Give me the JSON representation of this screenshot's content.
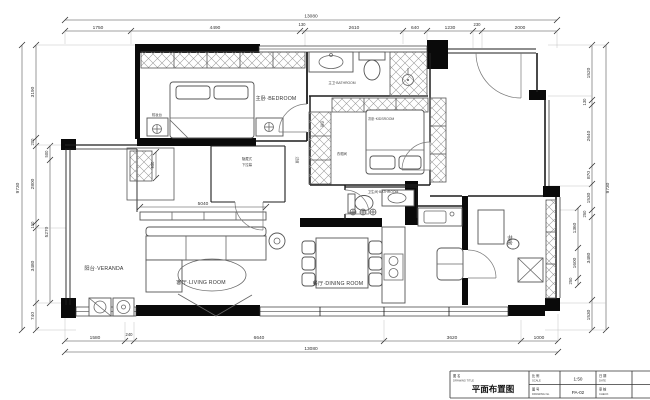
{
  "dims": {
    "top": {
      "overall": "13080",
      "segments": [
        "1750",
        "4490",
        "130",
        "2610",
        "640",
        "1230",
        "230",
        "2000"
      ]
    },
    "bottom": {
      "overall": "13080",
      "segments": [
        "1580",
        "240",
        "6640",
        "3620",
        "1000"
      ]
    },
    "left": {
      "overall": "9730",
      "segments": [
        "3190",
        "200",
        "2800",
        "150",
        "3480",
        "740"
      ],
      "inner": [
        "500",
        "5270"
      ]
    },
    "right": {
      "overall": "9730",
      "segments": [
        "1520",
        "130",
        "2640",
        "870",
        "1530",
        "250",
        "3480",
        "1530"
      ],
      "inner": [
        "1360",
        "1600",
        "250"
      ]
    },
    "interior": {
      "sofa_wall": "5040",
      "closet_depth": "950"
    }
  },
  "rooms": {
    "master_bedroom": "主卧·BEDROOM",
    "master_bath": "主卫·BATHROOM",
    "kids_room": "次卧·KIDSROOM",
    "wardrobe": "衣柜",
    "closet": "衣帽间",
    "bathroom": "卫生间·BATHROOM",
    "dining": "餐厅·DINING ROOM",
    "living": "客厅·LIVING ROOM",
    "veranda": "阳台·VERANDA",
    "study": "书房",
    "hallway": "过道",
    "dresser": "梳妆台",
    "projector_l1": "隐藏式",
    "projector_l2": "下拉幕"
  },
  "titleblock": {
    "name_label": "图 名",
    "name_label_en": "DRAWING TITLE",
    "title": "平面布置图",
    "scale_label": "比 例",
    "scale_label_en": "SCALE",
    "scale_value": "1:50",
    "no_label": "图 号",
    "no_label_en": "DRAWING No.",
    "no_value": "PA-02",
    "date_label": "日 期",
    "date_label_en": "DATE",
    "check_label": "审 核",
    "check_label_en": "CHECK"
  }
}
